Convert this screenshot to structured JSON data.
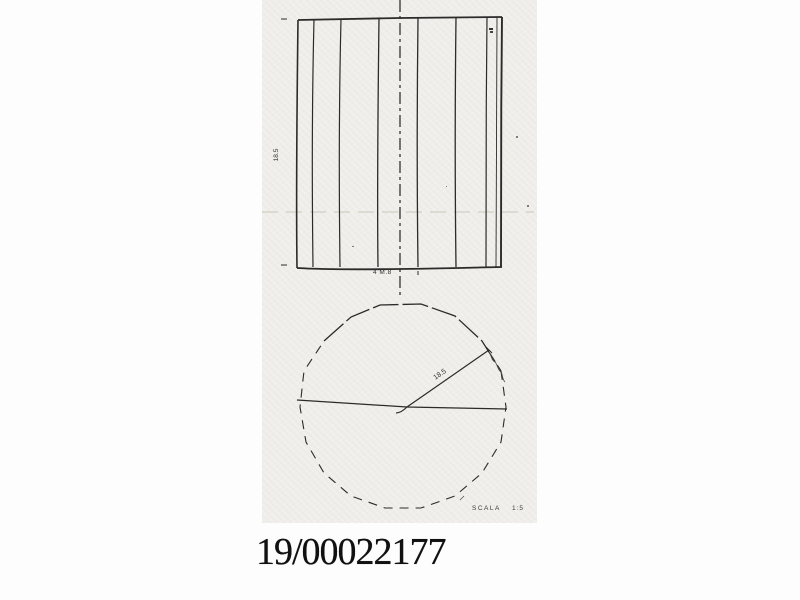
{
  "artifact": {
    "catalog_number": "19/00022177",
    "scale": {
      "label": "SCALA",
      "value": "1:5"
    },
    "elevation_view": {
      "height_dim": "18.5",
      "base_dim": "4 M.8"
    },
    "plan_view": {
      "radius_dim": "18.5"
    }
  },
  "colors": {
    "ink": "#2b2b2b",
    "paper": "#f1f0ec",
    "page": "#fdfdfd"
  }
}
